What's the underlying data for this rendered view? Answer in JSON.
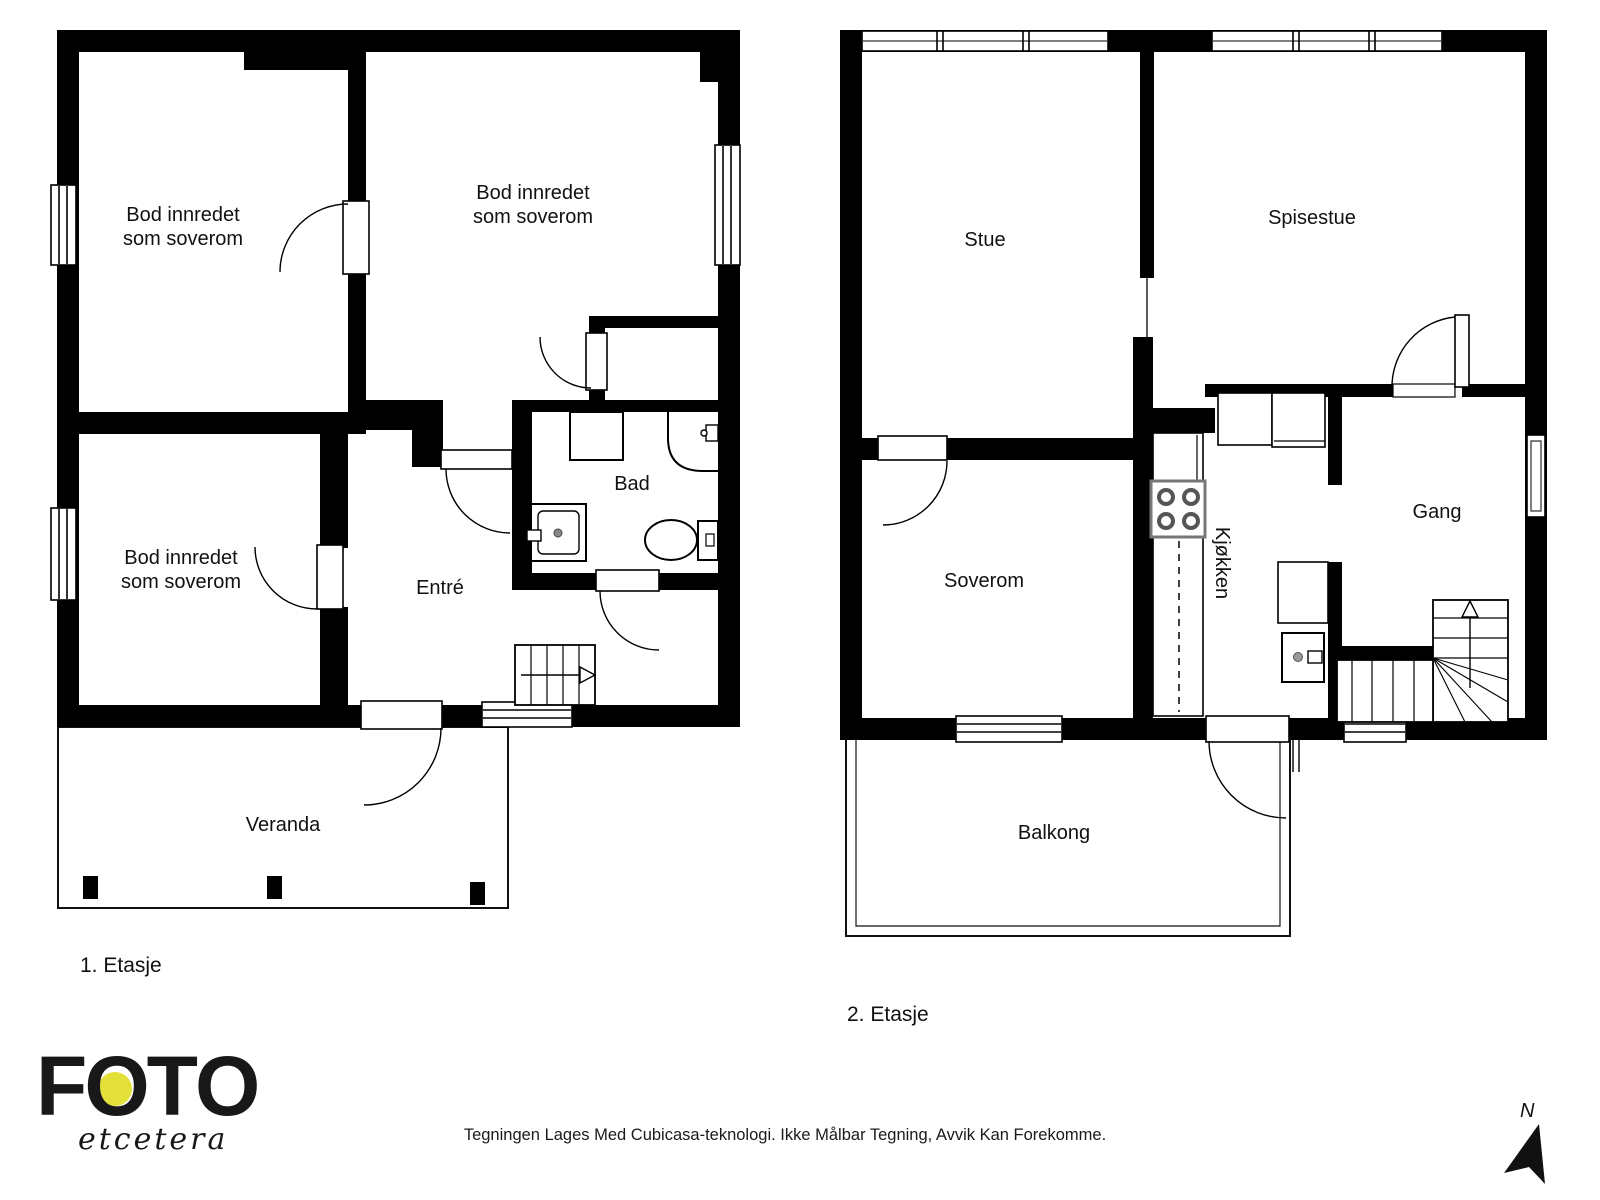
{
  "floor1": {
    "label": "1. Etasje",
    "rooms": {
      "bod_top_left": "Bod innredet som soverom",
      "bod_top_right": "Bod innredet som soverom",
      "bod_bottom_left": "Bod innredet som soverom",
      "entre": "Entré",
      "bad": "Bad",
      "veranda": "Veranda"
    }
  },
  "floor2": {
    "label": "2. Etasje",
    "rooms": {
      "stue": "Stue",
      "spisestue": "Spisestue",
      "soverom": "Soverom",
      "kjokken": "Kjøkken",
      "gang": "Gang",
      "balkong": "Balkong"
    }
  },
  "branding": {
    "logo_main": "F,O,T,O",
    "logo_sub": "etcetera",
    "accent_color": "#e4e03a"
  },
  "footer": {
    "disclaimer": "Tegningen Lages Med Cubicasa-teknologi. Ikke Målbar Tegning, Avvik Kan Forekomme."
  },
  "compass": {
    "label": "N"
  }
}
